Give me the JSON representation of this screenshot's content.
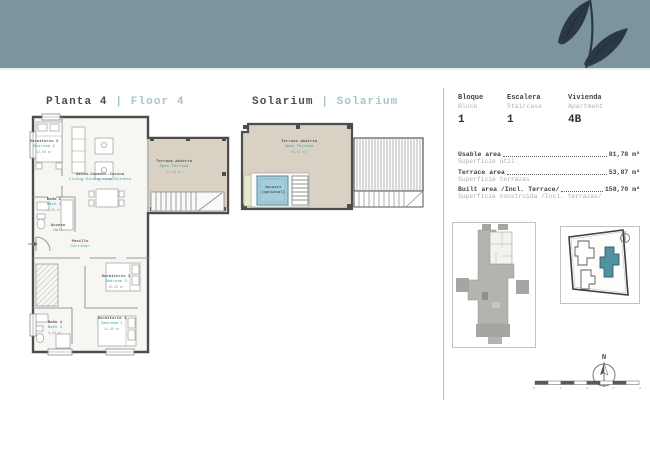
{
  "floor_plan": {
    "title": {
      "es": "Planta 4",
      "divider": "|",
      "en": "Floor 4"
    },
    "rooms": [
      {
        "es": "Dormitorio 2",
        "en": "Bedroom 2",
        "area": "12,06 m²"
      },
      {
        "es": "Salón-Comedor-Cocina",
        "en": "Living-Dining room-Kitchen",
        "area": ""
      },
      {
        "es": "Terraza abierta",
        "en": "Open Terrace",
        "area": "11,25 m²"
      },
      {
        "es": "Baño 2",
        "en": "Bath 2",
        "area": "3,95 m²"
      },
      {
        "es": "Acceso",
        "en": "Hall",
        "area": ""
      },
      {
        "es": "Pasillo",
        "en": "Corridor",
        "area": ""
      },
      {
        "es": "Dormitorio 3",
        "en": "Bedroom 3",
        "area": "10,45 m²"
      },
      {
        "es": "Dormitorio 1",
        "en": "Bedroom 1",
        "area": "12,60 m²"
      },
      {
        "es": "Baño 1",
        "en": "Bath 1",
        "area": "4,20 m²"
      }
    ]
  },
  "solarium": {
    "title": {
      "es": "Solarium",
      "divider": "|",
      "en": "Solarium"
    },
    "terrace": {
      "es": "Terraza abierta",
      "en": "Open Terrace",
      "area": "42,62 m²"
    },
    "jacuzzi": {
      "line1": "Jacuzzi",
      "line2": "(opcional)"
    }
  },
  "info": {
    "fields": [
      {
        "es": "Bloque",
        "en": "Block",
        "value": "1"
      },
      {
        "es": "Escalera",
        "en": "Staircase",
        "value": "1"
      },
      {
        "es": "Vivienda",
        "en": "Apartment",
        "value": "4B"
      }
    ],
    "areas": [
      {
        "en": "Usable area",
        "value": "81,78 m²",
        "es": "Superficie útil"
      },
      {
        "en": "Terrace area",
        "value": "53,87 m²",
        "es": "Superficie terrazas"
      },
      {
        "en": "Built area /Incl. Terrace/",
        "value": "158,70 m²",
        "es": "Superficie construida /Incl. terrazas/"
      }
    ]
  },
  "compass": {
    "label": "N"
  },
  "scale_bar": {
    "labels": [
      "0",
      "2",
      "4",
      "6",
      "8"
    ]
  },
  "colors": {
    "banner": "#7c93a0",
    "leaf": "#2b3847",
    "accent_teal": "#2fa8ad",
    "terrace_fill": "#d9d1c3",
    "jacuzzi_fill": "#a5cedb",
    "site_highlight": "#4f93a3"
  }
}
